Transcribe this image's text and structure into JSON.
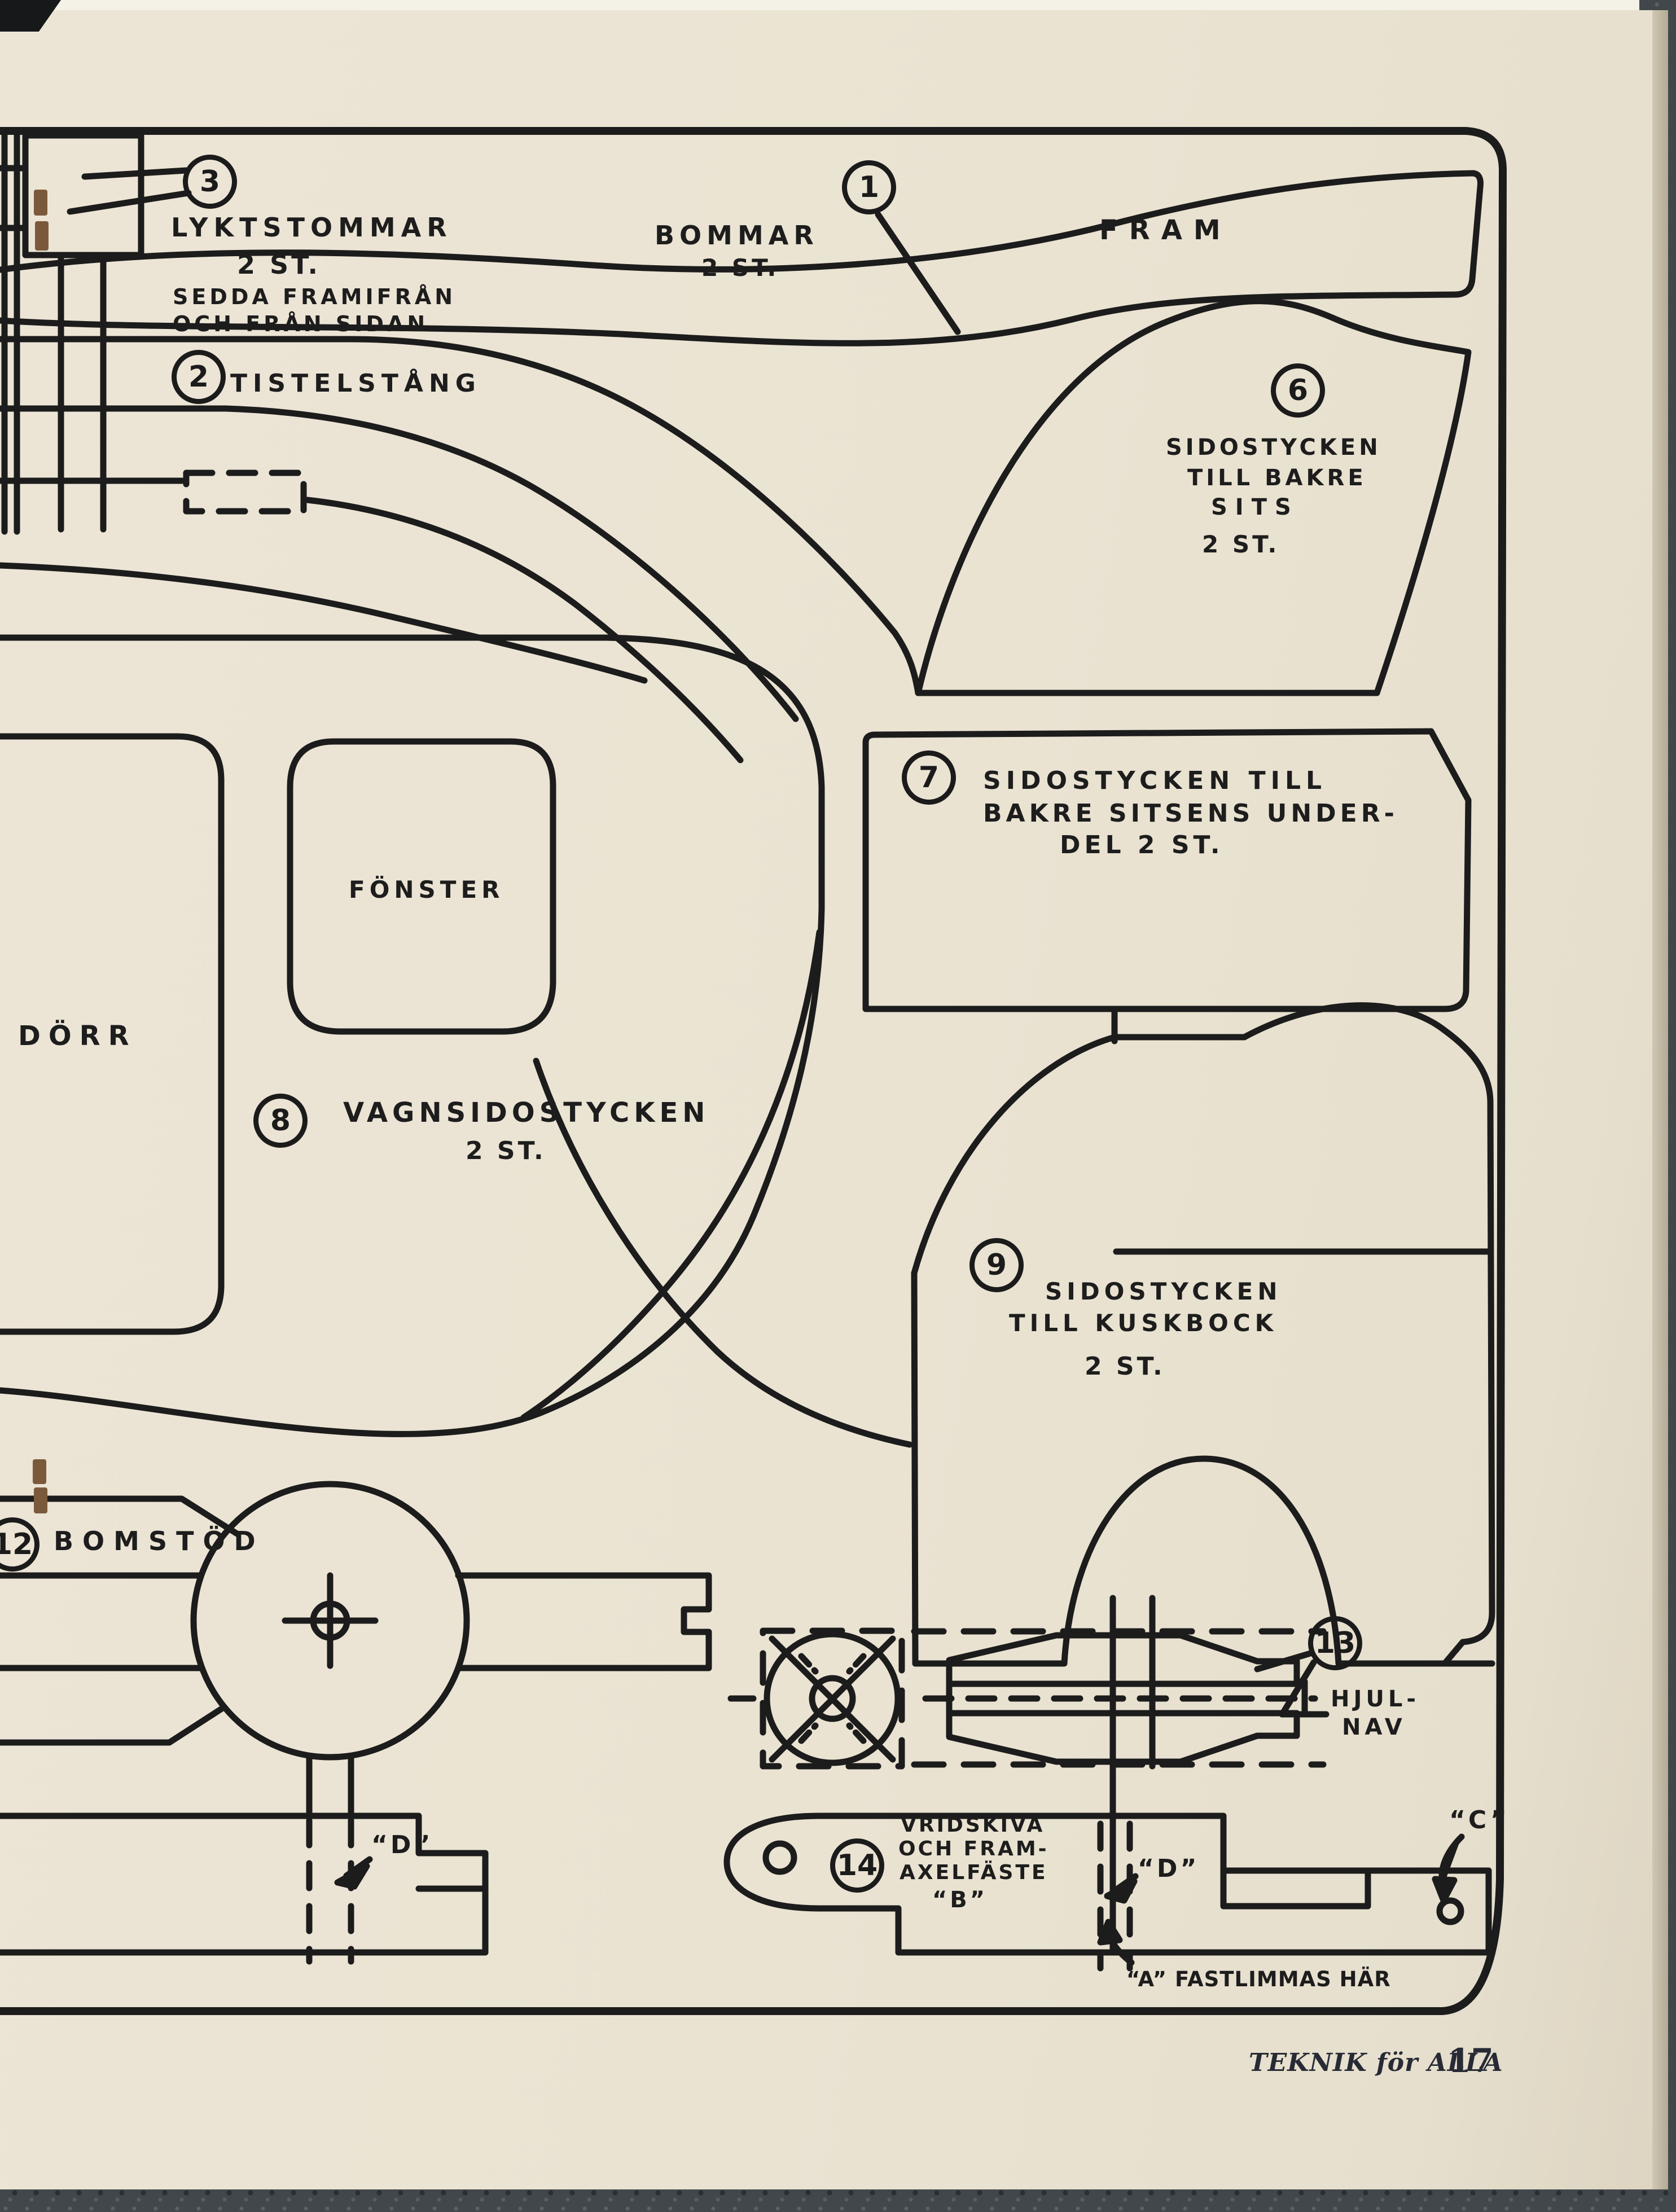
{
  "page": {
    "publication": "TEKNIK för ALLA",
    "page_number": "17"
  },
  "colors": {
    "paper": "#eae3d2",
    "ink": "#1c1c1c",
    "background": "#42474b",
    "staple_rust": "#7b5a3c"
  },
  "part_numbers": {
    "n1": "1",
    "n2": "2",
    "n3": "3",
    "n6": "6",
    "n7": "7",
    "n8": "8",
    "n9": "9",
    "n12": "12",
    "n13": "13",
    "n14": "14"
  },
  "labels": {
    "lyktstommar_title": "LYKTSTOMMAR",
    "lyktstommar_count": "2 ST.",
    "lyktstommar_sub1": "SEDDA FRAMIFRÅN",
    "lyktstommar_sub2": "OCH FRÅN SIDAN",
    "bommar": "BOMMAR",
    "bommar_count": "2 ST.",
    "fram": "FRAM",
    "tistelstang": "TISTELSTÅNG",
    "sits_l1": "SIDOSTYCKEN",
    "sits_l2": "TILL BAKRE",
    "sits_l3": "SITS",
    "sits_count": "2 ST.",
    "underdel_l1": "SIDOSTYCKEN TILL",
    "underdel_l2": "BAKRE SITSENS UNDER-",
    "underdel_l3": "DEL 2 ST.",
    "fonster": "FÖNSTER",
    "dorr": "DÖRR",
    "vagnsido": "VAGNSIDOSTYCKEN",
    "vagnsido_count": "2 ST.",
    "kuskbock_l1": "SIDOSTYCKEN",
    "kuskbock_l2": "TILL KUSKBOCK",
    "kuskbock_count": "2 ST.",
    "bomstod": "BOMSTÖD",
    "hjulnav_l1": "HJUL-",
    "hjulnav_l2": "NAV",
    "vridskiva_l1": "VRIDSKIVA",
    "vridskiva_l2": "OCH FRAM-",
    "vridskiva_l3": "AXELFÄSTE",
    "ref_b": "“B”",
    "ref_d_left": "“D”",
    "ref_d_right": "“D”",
    "ref_c": "“C”",
    "fastlimmas": "“A” FASTLIMMAS HÄR"
  }
}
